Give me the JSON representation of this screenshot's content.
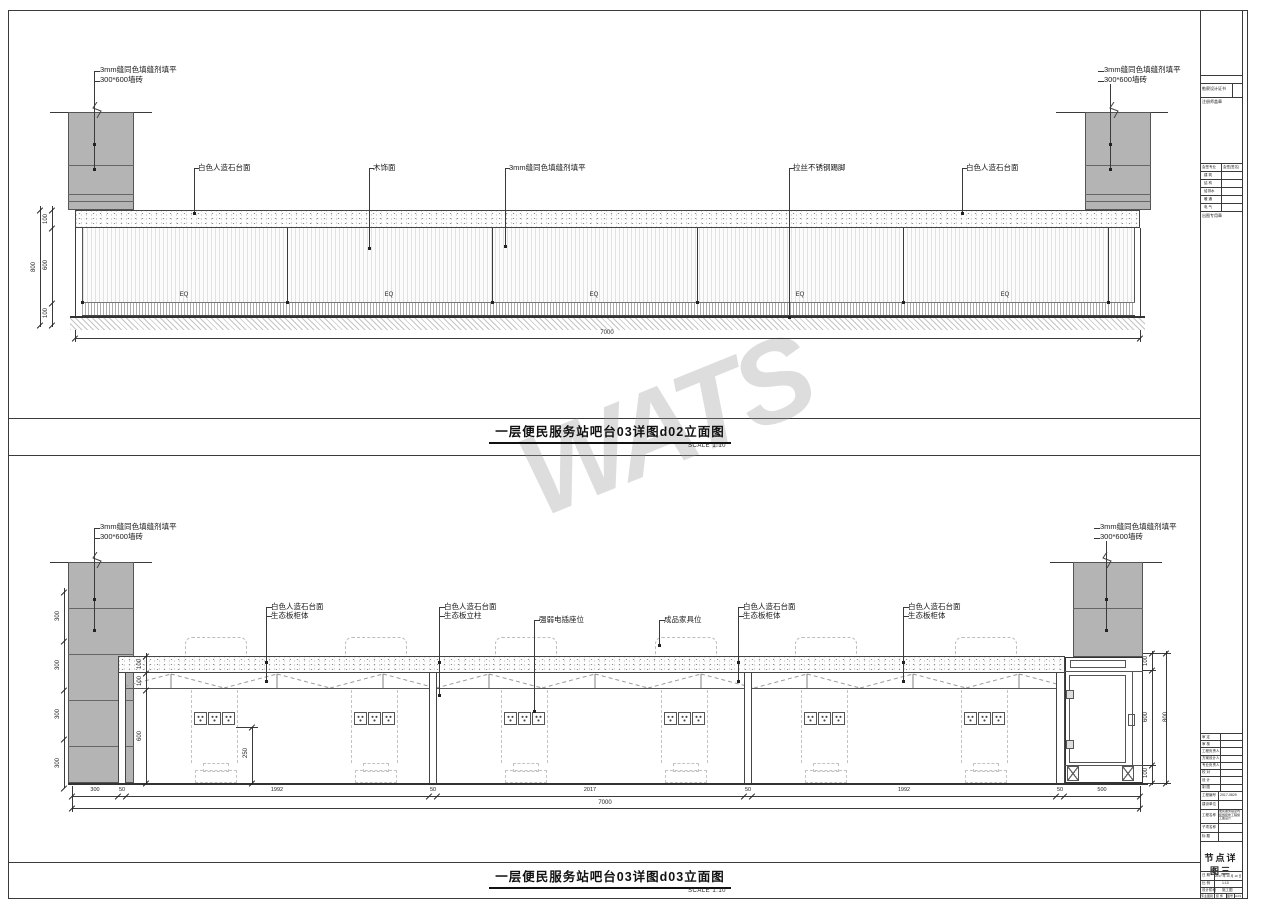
{
  "sheet": {
    "watermark": "WATS"
  },
  "titles": {
    "d02": {
      "text": "一层便民服务站吧台03详图d02立面图",
      "scale": "SCALE 1:10"
    },
    "d03": {
      "text": "一层便民服务站吧台03详图d03立面图",
      "scale": "SCALE 1:10"
    }
  },
  "d02": {
    "ann": {
      "left_pillar": [
        "3mm缝同色填缝剂填平",
        "300*600墙砖"
      ],
      "right_pillar": [
        "3mm缝同色填缝剂填平",
        "300*600墙砖"
      ],
      "a1": "白色人造石台面",
      "a2": "木饰面",
      "a3": "3mm缝同色填缝剂填平",
      "a4": "拉丝不锈钢踢脚",
      "a5": "白色人造石台面"
    },
    "eq": "EQ",
    "dims": {
      "h100a": "100",
      "h600": "600",
      "h100b": "100",
      "h800": "800",
      "total": "7000"
    }
  },
  "d03": {
    "ann": {
      "left_pillar": [
        "3mm缝同色填缝剂填平",
        "300*600墙砖"
      ],
      "right_pillar": [
        "3mm缝同色填缝剂填平",
        "300*600墙砖"
      ],
      "a1": [
        "白色人造石台面",
        "生态板柜体"
      ],
      "a2": [
        "白色人造石台面",
        "生态板立柱"
      ],
      "a3": "强弱电插座位",
      "a4": "成品家具位",
      "a5": [
        "白色人造石台面",
        "生态板柜体"
      ],
      "a6": [
        "白色人造石台面",
        "生态板柜体"
      ]
    },
    "left_dims": [
      "300",
      "300",
      "300",
      "300"
    ],
    "counter_dims": [
      "100",
      "100",
      "600"
    ],
    "socket_dim": "250",
    "right_dims": {
      "t": "100",
      "m": "600",
      "b": "100",
      "total": "800"
    },
    "bottom_dims": [
      "300",
      "50",
      "1992",
      "50",
      "2017",
      "50",
      "1992",
      "50",
      "500"
    ],
    "total": "7000"
  },
  "titleblock": {
    "cert": "勘察设计证书",
    "seal_note": "注册师盖章",
    "sig_header": [
      "会签专业",
      "会签(签名)"
    ],
    "sig_rows": [
      "建 筑",
      "结 构",
      "给排水",
      "暖 通",
      "电 气"
    ],
    "stamp_note": "出图专用章",
    "personnel": [
      "审 定",
      "审 核",
      "工程负责人",
      "方案设计人",
      "专业负责人",
      "校 对",
      "设 计",
      "制 图"
    ],
    "project_no_label": "工程编号",
    "project_no": "2017-0829",
    "client_label": "建设单位",
    "project_label": "工程名称",
    "project_name": "便民服务站室内装饰装修工程施工图设计",
    "sub_label": "子项名称",
    "title_label": "标  题",
    "sheet_title": "节点详图三",
    "date_label": "日  期",
    "date": "2017 年 10 月 19 日",
    "scale_label": "比  例",
    "scale": "1:10",
    "stage_label": "设计阶段",
    "stage": "施工图",
    "cat_label": "专业图别",
    "cat": "装 饰",
    "no_label": "图号",
    "no": "d-03",
    "size_label": "图 幅",
    "size": "A2"
  }
}
